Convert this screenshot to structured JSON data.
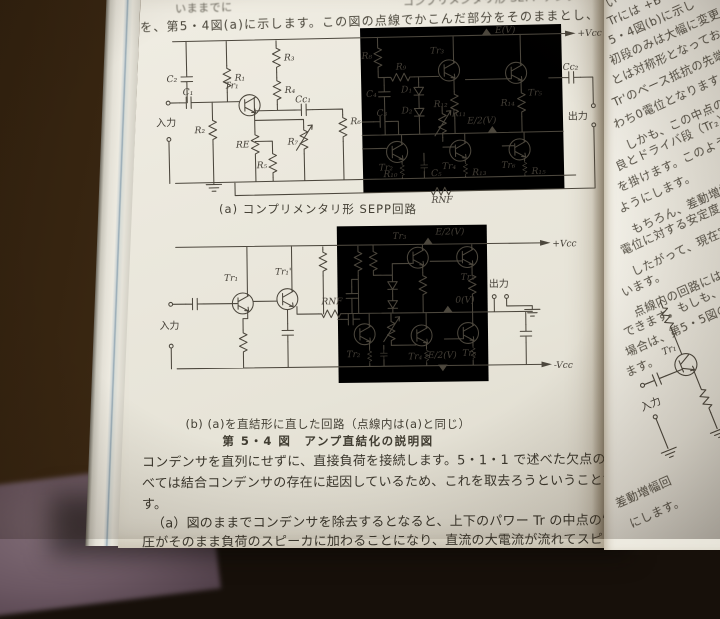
{
  "header": {
    "line1_left": "いままでに",
    "line1_right": "コンプリメンタリ形 SEPP アンプ",
    "line2": "を、第5・4図(a)に示します。この図の点線でかこんだ部分をそのままとし、"
  },
  "captions": {
    "figure": "第 5・4 図　アンプ直結化の説明図"
  },
  "circuit_a": {
    "caption": "(a) コンプリメンタリ形 SEPP回路",
    "labels": {
      "input": "入力",
      "output": "出力",
      "vcc": "+Vcc",
      "rnf": "RNF",
      "c1": "C₁",
      "c2": "C₂",
      "c3": "C₃",
      "c4": "C₄",
      "c5": "C₅",
      "cc1": "Cc₁",
      "cc2": "Cc₂",
      "r1": "R₁",
      "r2": "R₂",
      "r3": "R₃",
      "r4": "R₄",
      "r5": "R₅",
      "r6": "R₆",
      "r7": "R₇",
      "r8": "R₈",
      "r9": "R₉",
      "r10": "R₁₀",
      "r11": "R₁₁",
      "r12": "R₁₂",
      "r13": "R₁₃",
      "r14": "R₁₄",
      "r15": "R₁₅",
      "re": "RE",
      "d1": "D₁",
      "d2": "D₂",
      "tr1": "Tr₁",
      "tr2": "Tr₂",
      "tr3": "Tr₃",
      "tr4": "Tr₄",
      "tr5": "Tr₅",
      "tr6": "Tr₆",
      "ev": "E(V)",
      "e2v": "E/2(V)"
    }
  },
  "circuit_b": {
    "caption": "(b) (a)を直結形に直した回路（点線内は(a)と同じ）",
    "labels": {
      "input": "入力",
      "output": "出力",
      "vcc": "+Vcc",
      "vee": "-Vcc",
      "rnf": "RNF",
      "tr1": "Tr₁",
      "tr1p": "Tr₁'",
      "tr2": "Tr₂",
      "tr3": "Tr₃",
      "tr4": "Tr₄",
      "tr5": "Tr₅",
      "tr6": "Tr₆",
      "e2v": "E/2(V)",
      "zerov": "0(V)",
      "me2v": "-E/2(V)"
    }
  },
  "body_text": {
    "p1l1": "コンデンサを直列にせずに、直接負荷を接続します。5・1・1 で述べた欠点のす",
    "p1l2": "べては結合コンデンサの存在に起因しているため、これを取去ろうということで",
    "p1l3": "す。",
    "p2l1": "（a）図のままでコンデンサを除去するとなると、上下のパワー Tr の中点の電",
    "p2l2": "圧がそのまま負荷のスピーカに加わることになり、直流の大電流が流れてスピー"
  },
  "right_page": {
    "lines": [
      "い",
      "Trには +B",
      "5・4図(b)に示し",
      "初段のみは大幅に変更",
      "とは対称形となっており、Tr",
      "Tr'のベース抵抗の先端すな",
      "わち0電位となります。",
      "しかも、この中点の変動を",
      "良とドライバ段（Tr₂）との",
      "を掛けます。このように",
      "ようにします。",
      "もちろん、差動増幅器",
      "電位に対する安定度とい",
      "したがって、現在実用化",
      "います。",
      "点線内の回路には適",
      "できます。もしも、ド",
      "場合は、第5・5図の",
      "ます。"
    ],
    "circuit": {
      "tr1": "Tr₁",
      "input": "入力"
    },
    "bottom1": "差動増幅回",
    "bottom2": "にします。"
  },
  "colors": {
    "paper": "#eae7dc",
    "paper_right": "#f2f0e8",
    "ink": "#3b372d",
    "wood": "#37230f",
    "carpet": "#6b5762",
    "fore_edge_blue": "#93a7b3"
  }
}
